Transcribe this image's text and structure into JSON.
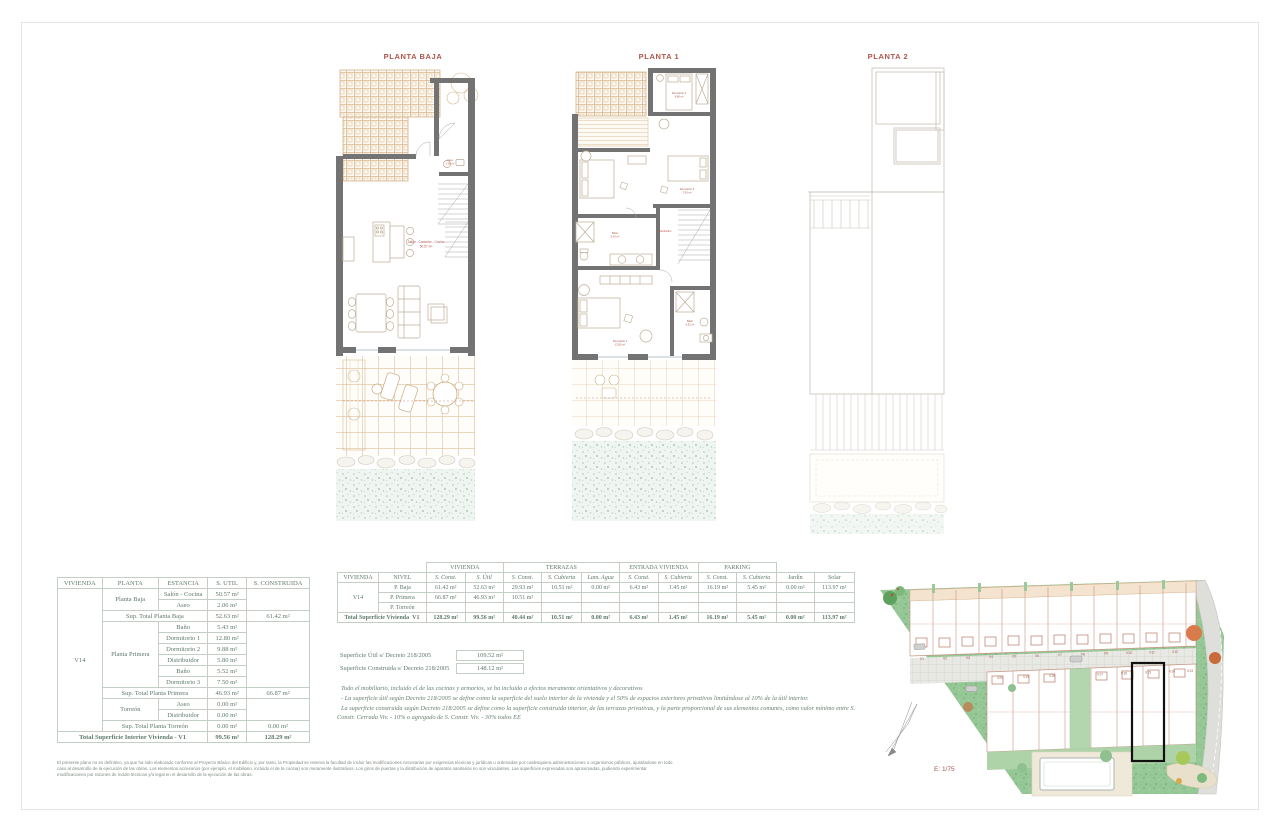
{
  "colors": {
    "accent_red": "#B0544A",
    "plan_wall_gray": "#737373",
    "pergola_tan": "#D8B58E",
    "site_green": "#96C796",
    "table_text": "#5F7A6C",
    "table_border": "#C3CEC5",
    "highlight_black": "#111111"
  },
  "plans": [
    {
      "title": "PLANTA BAJA"
    },
    {
      "title": "PLANTA 1"
    },
    {
      "title": "PLANTA 2"
    }
  ],
  "plan_labels": {
    "pb_room": "Salón - Comedor - Cocina",
    "pb_room_area": "50.57 m²",
    "pb_aseo": "Aseo",
    "pb_aseo_area": "2.06 m²",
    "p1_dorm1": "Dormitorio 1",
    "p1_dorm1_area": "12.80 m²",
    "p1_dorm2": "Dormitorio 2",
    "p1_dorm2_area": "9.88 m²",
    "p1_dorm3": "Dormitorio 3",
    "p1_dorm3_area": "7.50 m²",
    "p1_bano": "Baño",
    "p1_bano_area": "5.43 m²",
    "p1_bano2": "Baño",
    "p1_bano2_area": "5.52 m²",
    "p1_distrib": "Distribuidor"
  },
  "left_table": {
    "headers": [
      "VIVIENDA",
      "PLANTA",
      "ESTANCIA",
      "S. UTIL",
      "S. CONSTRUIDA"
    ],
    "vivienda": "V14",
    "rows": [
      {
        "planta": "Planta Baja",
        "estancia": "Salón - Cocina",
        "util": "50.57 m²"
      },
      {
        "estancia": "Aseo",
        "util": "2.06 m²"
      },
      {
        "label": "Sup. Total Planta Baja",
        "util": "52.63 m²",
        "construida": "61.42 m²"
      },
      {
        "planta": "Planta Primera",
        "estancia": "Baño",
        "util": "5.43 m²"
      },
      {
        "estancia": "Dormitorio 1",
        "util": "12.80 m²"
      },
      {
        "estancia": "Dormitorio 2",
        "util": "9.88 m²"
      },
      {
        "estancia": "Distribuidor",
        "util": "5.80 m²"
      },
      {
        "estancia": "Baño",
        "util": "5.52 m²"
      },
      {
        "estancia": "Dormitorio 3",
        "util": "7.50 m²"
      },
      {
        "label": "Sup. Total Planta Primera",
        "util": "46.93 m²",
        "construida": "66.87 m²"
      },
      {
        "planta": "Torreón",
        "estancia": "Aseo",
        "util": "0.00 m²"
      },
      {
        "estancia": "Distribuidor",
        "util": "0.00 m²"
      },
      {
        "label": "Sup. Total Planta Torreón",
        "util": "0.00 m²",
        "construida": "0.00 m²"
      }
    ],
    "total": {
      "label": "Total Superficie Interior Vivienda - V1",
      "util": "99.56 m²",
      "construida": "128.29 m²"
    }
  },
  "right_table": {
    "col_headers": {
      "vivienda": "VIVIENDA",
      "nivel": "NIVEL",
      "jardin": "Jardín",
      "solar": "Solar"
    },
    "groups": [
      {
        "label": "VIVIENDA",
        "cols": [
          "S. Const.",
          "S. Útil"
        ]
      },
      {
        "label": "TERRAZAS",
        "cols": [
          "S. Const.",
          "S. Cubierta",
          "Lam. Agua"
        ]
      },
      {
        "label": "ENTRADA VIVIENDA",
        "cols": [
          "S. Const.",
          "S. Cubierta"
        ]
      },
      {
        "label": "PARKING",
        "cols": [
          "S. Const.",
          "S. Cubierta"
        ]
      }
    ],
    "vivienda": "V14",
    "body": [
      {
        "nivel": "P. Baja",
        "cells": [
          "61.42 m²",
          "52.63 m²",
          "29.93 m²",
          "10.51 m²",
          "0.00 m²",
          "6.43 m²",
          "1.45 m²",
          "16.19 m²",
          "5.45 m²",
          "0.00 m²",
          "113.97 m²"
        ]
      },
      {
        "nivel": "P. Primera",
        "cells": [
          "66.87 m²",
          "46.93 m²",
          "10.51 m²",
          "",
          "",
          "",
          "",
          "",
          "",
          "",
          ""
        ]
      },
      {
        "nivel": "P. Torreón",
        "cells": [
          "",
          "",
          "",
          "",
          "",
          "",
          "",
          "",
          "",
          "",
          ""
        ]
      }
    ],
    "total": {
      "label": "Total Superficie Vivienda",
      "unit": "V1",
      "cells": [
        "128.29 m²",
        "99.56 m²",
        "40.44 m²",
        "10.51 m²",
        "0.00 m²",
        "6.43 m²",
        "1.45 m²",
        "16.19 m²",
        "5.45 m²",
        "0.00 m²",
        "113.97 m²"
      ]
    }
  },
  "superficie": {
    "util_label": "Superficie Útil s/ Decreto 218/2005",
    "util_value": "109.52 m²",
    "construida_label": "Superficie Construida s/ Decreto 218/2005",
    "construida_value": "148.12 m²"
  },
  "notes": {
    "n1": "Todo el mobiliario, incluido el de las cocinas y armarios, se ha incluido a efectos meramente orientativos y decorativos",
    "n2": "- La superficie útil según Decreto 218/2005 se define como la superficie del suelo interior de la vivienda y el 50% de espacios exteriores privativos limitándose al 10% de la útil interior.",
    "n3": "La superficie construida según Decreto 218/2005 se define como la superficie construida interior, de las terrazas privativas, y la parte proporcional de sus elementos comunes, como valor mínimo entre S. Constr. Cerrada Viv. - 10% o agregado de S. Constr. Viv. - 30% todos EE"
  },
  "disclaimer": "El presente plano no es definitivo, ya que ha sido elaborado conforme al Proyecto Básico del Edificio y, por tanto, la Propiedad se reserva la facultad de incluir las modificaciones necesarias por exigencias técnicas y jurídicas u ordenadas por cualesquiera administraciones u organismos públicos, ajustándose en todo caso al desarrollo de la ejecución de las obras. Los elementos accesorios (por ejemplo, el mobiliario, incluido el de la cocina) son meramente ilustrativos. Los giros de puertas y la distribución de aparatos sanitarios no son vinculantes. Las superficies expresadas son aproximadas, pudiendo experimentar modificaciones por razones de índole técnicas y/o legal en el desarrollo de la ejecución de las obras.",
  "site_plan": {
    "scale_label": "E: 1/75",
    "highlighted_unit": "V14",
    "units_top": [
      "V1",
      "V2",
      "V3",
      "V4",
      "V5",
      "V6",
      "V7",
      "V8",
      "V9",
      "V10",
      "V11",
      "V12"
    ],
    "units_bottom": [
      "V20",
      "V19",
      "V18",
      "V17",
      "V16",
      "V15",
      "V14",
      "V13"
    ]
  }
}
